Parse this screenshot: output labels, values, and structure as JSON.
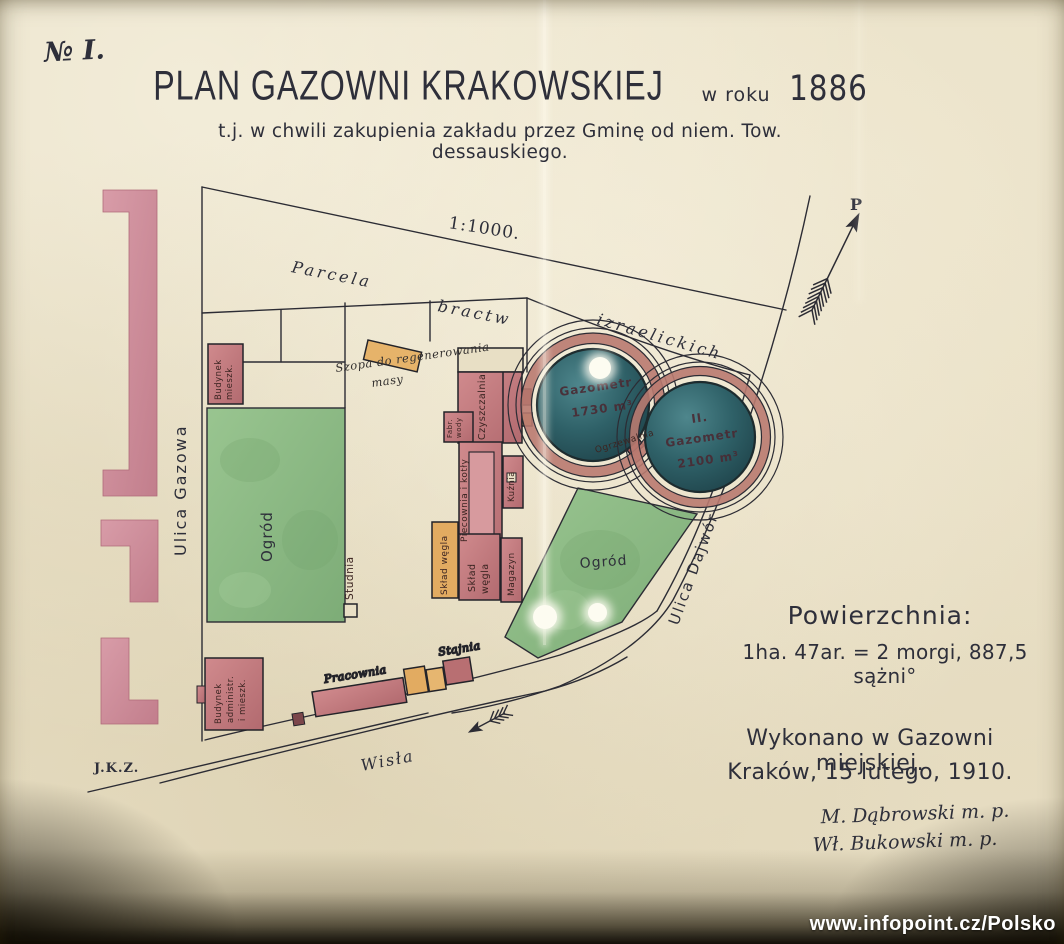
{
  "meta": {
    "sheet_no": "№ I.",
    "initials": "J.K.Z.",
    "watermark": "www.infopoint.cz/Polsko"
  },
  "title": {
    "main": "PLAN GAZOWNI KRAKOWSKIEJ",
    "year_prefix": "w roku",
    "year": "1886",
    "subtitle": "t.j. w chwili zakupienia zakładu przez Gminę od niem. Tow. dessauskiego."
  },
  "map": {
    "scale": "1:1000.",
    "north": "P",
    "parcel_band": {
      "w1": "Parcela",
      "w2": "bractw",
      "w3": "izraelickich"
    },
    "streets": {
      "gazowa": "Ulica Gazowa",
      "dajwor": "Ulica Dajwór",
      "river": "Wisła"
    },
    "gardens": {
      "west": "Ogród",
      "east": "Ogród"
    },
    "well": "Studnia",
    "gasometers": {
      "g1_name": "Gazometr",
      "g1_volume": "1730 m³",
      "g2_number": "II.",
      "g2_name": "Gazometr",
      "g2_volume": "2100 m³"
    },
    "buildings": {
      "dwelling_l1": "Budynek",
      "dwelling_l2": "mieszk.",
      "shed_l1": "Szopa do regenerowania",
      "shed_l2": "masy",
      "purifier": "Czyszczalnia",
      "water_l1": "Fabr.",
      "water_l2": "wody",
      "retort_house": "Piecownia i kotły",
      "forge": "Kuźnia",
      "coal_store_a": "Skład węgla",
      "coal_store_b_l1": "Skład",
      "coal_store_b_l2": "węgla",
      "warehouse": "Magazyn",
      "heater": "Ogrzewalnia",
      "workshop": "Pracownia",
      "stable": "Stajnia",
      "admin_l1": "Budynek",
      "admin_l2": "administr.",
      "admin_l3": "i mieszk."
    }
  },
  "notes": {
    "area_title": "Powierzchnia:",
    "area_value": "1ha. 47ar. = 2 morgi, 887,5 sążni°",
    "made_in": "Wykonano w Gazowni miejskiej.",
    "place_date": "Kraków, 15 lutego, 1910.",
    "signature_1": "M. Dąbrowski m. p.",
    "signature_2": "Wł. Bukowski m. p."
  },
  "colors": {
    "paper": "#e8dfc5",
    "ink": "#2c2c34",
    "building_red": "#c9807f",
    "building_orange": "#e2ab61",
    "wall_pink": "#d393a0",
    "garden_green": "#8cbb84",
    "gasholder_teal": "#2f6168",
    "ring_brick": "#b97a70"
  }
}
